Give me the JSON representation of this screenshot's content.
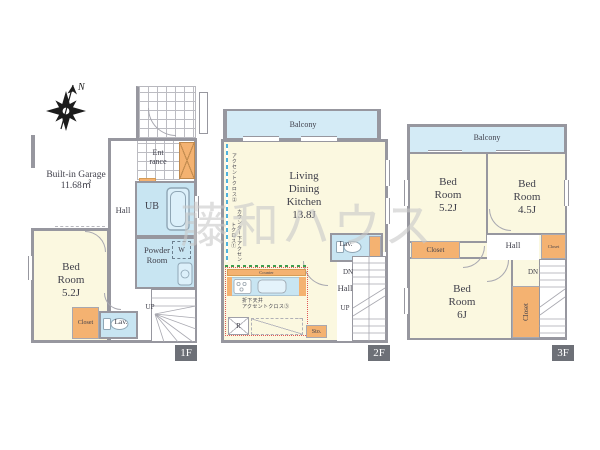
{
  "watermark": "藤和ハウス",
  "compass": {
    "north_label": "N"
  },
  "colors": {
    "wall": "#97979f",
    "room_yellow": "#fbf8e0",
    "water_blue": "#c8e5f2",
    "balcony_blue": "#d4ebf6",
    "closet_orange": "#f4b271",
    "floor_tag_bg": "#6d7077",
    "kitchen_accent_red": "#e05858",
    "counter_accent_green": "#3f9e4f",
    "accent_wall_blue": "#4fb2dd"
  },
  "floor1": {
    "tag": "1F",
    "garage_line1": "Built-in Garage",
    "garage_line2": "11.68㎡",
    "entrance_line1": "Ent",
    "entrance_line2": "rance",
    "hall": "Hall",
    "unit_bath": "UB",
    "washer": "W",
    "powder_line1": "Powder",
    "powder_line2": "Room",
    "bedroom_line1": "Bed",
    "bedroom_line2": "Room",
    "bedroom_line3": "5.2J",
    "closet": "Closet",
    "lavatory": "Lav.",
    "stairs_up": "UP"
  },
  "floor2": {
    "tag": "2F",
    "balcony": "Balcony",
    "ldk_line1": "Living",
    "ldk_line2": "Dining",
    "ldk_line3": "Kitchen",
    "ldk_line4": "13.8J",
    "accent_wall_note": "アクセントクロス②",
    "counter_accent_note": "カウンター下アクセントクロス①",
    "counter": "Counter",
    "ceiling_note_line1": "折下天井",
    "ceiling_note_line2": "アクセントクロス③",
    "refrigerator": "R",
    "storage": "Sto.",
    "lavatory": "Lav.",
    "hall": "Hall",
    "stairs_down": "DN",
    "stairs_up": "UP"
  },
  "floor3": {
    "tag": "3F",
    "balcony": "Balcony",
    "bedroom1_line1": "Bed",
    "bedroom1_line2": "Room",
    "bedroom1_line3": "5.2J",
    "bedroom2_line1": "Bed",
    "bedroom2_line2": "Room",
    "bedroom2_line3": "4.5J",
    "bedroom3_line1": "Bed",
    "bedroom3_line2": "Room",
    "bedroom3_line3": "6J",
    "closet_left": "Closet",
    "closet_right": "Closet",
    "closet_bottom": "Closet",
    "hall": "Hall",
    "stairs_down": "DN"
  }
}
